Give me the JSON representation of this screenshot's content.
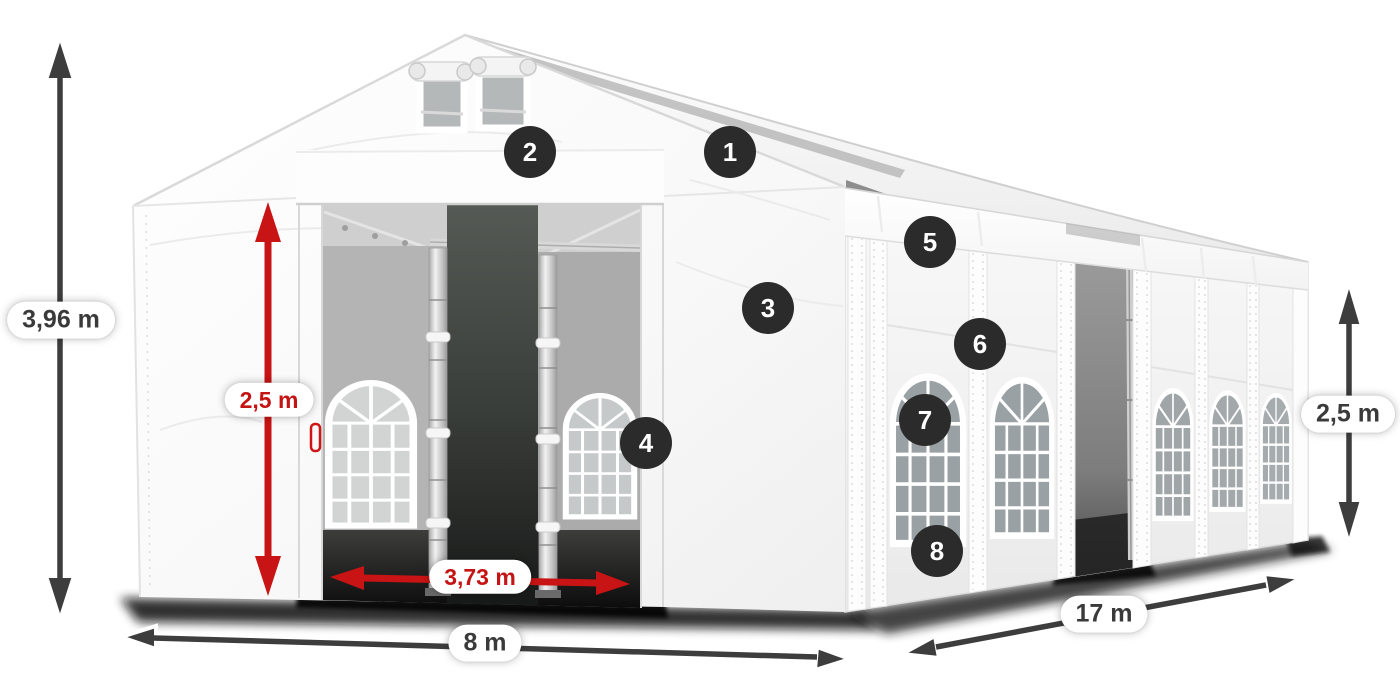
{
  "diagram": {
    "subject": "White marquee party tent with dimension annotations and numbered part callouts",
    "dimensions": {
      "total_height": {
        "value": "3,96 m"
      },
      "entrance_height": {
        "value": "2,5 m"
      },
      "entrance_width": {
        "value": "3,73 m"
      },
      "front_width": {
        "value": "8 m"
      },
      "side_length": {
        "value": "17 m"
      },
      "side_wall_height": {
        "value": "2,5 m"
      }
    },
    "callouts": [
      {
        "label": "1"
      },
      {
        "label": "2"
      },
      {
        "label": "3"
      },
      {
        "label": "4"
      },
      {
        "label": "5"
      },
      {
        "label": "6"
      },
      {
        "label": "7"
      },
      {
        "label": "8"
      }
    ],
    "colors": {
      "background": "#ffffff",
      "dimension_arrow_dark": "#3d3d3d",
      "dimension_accent_red": "#c81414",
      "callout_background": "#2b2b2b",
      "callout_text": "#ffffff",
      "label_text_dark": "#3a3a3a"
    }
  }
}
